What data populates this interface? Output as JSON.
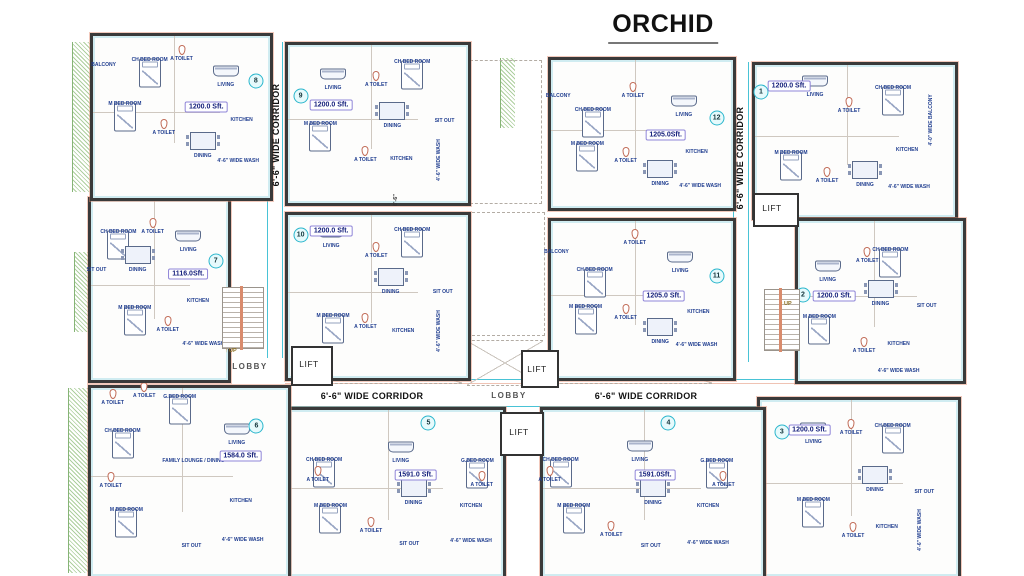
{
  "title": "ORCHID",
  "colors": {
    "wall": "#3a3a3a",
    "accent_cyan": "#49c3d6",
    "accent_orange": "#d98b6c",
    "hatch_green": "#6aa84e",
    "room_label_blue": "#1f3d8f",
    "badge_border": "#9086d8"
  },
  "units": [
    {
      "number": "1",
      "area": "1200.0 Sft.",
      "box": [
        752,
        62,
        200,
        152
      ],
      "circle": [
        3,
        18
      ],
      "badge": [
        17,
        14
      ],
      "rooms": [
        {
          "n": "LIVING",
          "x": 30,
          "y": 20
        },
        {
          "n": "CH BED ROOM",
          "x": 69,
          "y": 15
        },
        {
          "n": "A TOILET",
          "x": 47,
          "y": 30
        },
        {
          "n": "4'-0\" WIDE BALCONY",
          "x": 88,
          "y": 36,
          "v": true
        },
        {
          "n": "M BED ROOM",
          "x": 18,
          "y": 58
        },
        {
          "n": "A TOILET",
          "x": 36,
          "y": 76
        },
        {
          "n": "DINING",
          "x": 55,
          "y": 79
        },
        {
          "n": "KITCHEN",
          "x": 76,
          "y": 56
        },
        {
          "n": "4'-6\" WIDE WASH",
          "x": 77,
          "y": 80
        }
      ]
    },
    {
      "number": "2",
      "area": "1200.0 Sft.",
      "box": [
        795,
        218,
        165,
        160
      ],
      "circle": [
        3,
        46
      ],
      "badge": [
        22,
        47
      ],
      "rooms": [
        {
          "n": "LIVING",
          "x": 18,
          "y": 37
        },
        {
          "n": "CH BED ROOM",
          "x": 56,
          "y": 18
        },
        {
          "n": "A TOILET",
          "x": 42,
          "y": 25
        },
        {
          "n": "M BED ROOM",
          "x": 13,
          "y": 60
        },
        {
          "n": "DINING",
          "x": 50,
          "y": 52
        },
        {
          "n": "SIT OUT",
          "x": 78,
          "y": 53
        },
        {
          "n": "A TOILET",
          "x": 40,
          "y": 81
        },
        {
          "n": "KITCHEN",
          "x": 61,
          "y": 77
        },
        {
          "n": "4'-6\" WIDE WASH",
          "x": 61,
          "y": 94
        }
      ]
    },
    {
      "number": "3",
      "area": "1200.0 Sft.",
      "box": [
        757,
        397,
        198,
        176
      ],
      "circle": [
        11,
        18
      ],
      "badge": [
        25,
        17
      ],
      "rooms": [
        {
          "n": "LIVING",
          "x": 27,
          "y": 24
        },
        {
          "n": "A TOILET",
          "x": 46,
          "y": 19
        },
        {
          "n": "CH BED ROOM",
          "x": 67,
          "y": 15
        },
        {
          "n": "M BED ROOM",
          "x": 27,
          "y": 57
        },
        {
          "n": "DINING",
          "x": 58,
          "y": 51
        },
        {
          "n": "SIT OUT",
          "x": 83,
          "y": 52
        },
        {
          "n": "A TOILET",
          "x": 47,
          "y": 77
        },
        {
          "n": "KITCHEN",
          "x": 64,
          "y": 72
        },
        {
          "n": "4'-6\" WIDE WASH",
          "x": 81,
          "y": 74,
          "v": true
        }
      ]
    },
    {
      "number": "4",
      "area": "1591.0Sft.",
      "box": [
        540,
        407,
        220,
        166
      ],
      "circle": [
        57,
        8
      ],
      "badge": [
        51,
        39
      ],
      "rooms": [
        {
          "n": "CH BED ROOM",
          "x": 8,
          "y": 30
        },
        {
          "n": "LIVING",
          "x": 44,
          "y": 30
        },
        {
          "n": "G.BED ROOM",
          "x": 79,
          "y": 31
        },
        {
          "n": "A TOILET",
          "x": 3,
          "y": 42
        },
        {
          "n": "A TOILET",
          "x": 82,
          "y": 45
        },
        {
          "n": "M BED ROOM",
          "x": 14,
          "y": 58
        },
        {
          "n": "DINING",
          "x": 50,
          "y": 56
        },
        {
          "n": "KITCHEN",
          "x": 75,
          "y": 58
        },
        {
          "n": "A TOILET",
          "x": 31,
          "y": 75
        },
        {
          "n": "SIT OUT",
          "x": 49,
          "y": 82
        },
        {
          "n": "4'-6\" WIDE WASH",
          "x": 75,
          "y": 80
        }
      ]
    },
    {
      "number": "5",
      "area": "1591.0 Sft.",
      "box": [
        287,
        407,
        213,
        166
      ],
      "circle": [
        65,
        8
      ],
      "badge": [
        59,
        39
      ],
      "rooms": [
        {
          "n": "CH BED ROOM",
          "x": 16,
          "y": 30
        },
        {
          "n": "LIVING",
          "x": 52,
          "y": 31
        },
        {
          "n": "G.BED ROOM",
          "x": 88,
          "y": 31
        },
        {
          "n": "A TOILET",
          "x": 13,
          "y": 42
        },
        {
          "n": "A TOILET",
          "x": 90,
          "y": 45
        },
        {
          "n": "M BED ROOM",
          "x": 19,
          "y": 58
        },
        {
          "n": "DINING",
          "x": 58,
          "y": 56
        },
        {
          "n": "KITCHEN",
          "x": 85,
          "y": 58
        },
        {
          "n": "A TOILET",
          "x": 38,
          "y": 73
        },
        {
          "n": "SIT OUT",
          "x": 56,
          "y": 81
        },
        {
          "n": "4'-6\" WIDE WASH",
          "x": 85,
          "y": 79
        }
      ]
    },
    {
      "number": "6",
      "area": "1584.0 Sft.",
      "box": [
        88,
        385,
        197,
        188
      ],
      "circle": [
        84,
        20
      ],
      "badge": [
        76,
        36
      ],
      "rooms": [
        {
          "n": "A TOILET",
          "x": 11,
          "y": 8
        },
        {
          "n": "A TOILET",
          "x": 27,
          "y": 4
        },
        {
          "n": "G.BED ROOM",
          "x": 45,
          "y": 5
        },
        {
          "n": "CH BED ROOM",
          "x": 16,
          "y": 23
        },
        {
          "n": "LIVING",
          "x": 74,
          "y": 29
        },
        {
          "n": "FAMILY LOUNGE / DINING",
          "x": 52,
          "y": 39
        },
        {
          "n": "A TOILET",
          "x": 10,
          "y": 52
        },
        {
          "n": "M BED ROOM",
          "x": 18,
          "y": 65
        },
        {
          "n": "KITCHEN",
          "x": 76,
          "y": 60
        },
        {
          "n": "SIT OUT",
          "x": 51,
          "y": 84
        },
        {
          "n": "4'-6\" WIDE WASH",
          "x": 77,
          "y": 81
        }
      ]
    },
    {
      "number": "7",
      "area": "1116.0Sft.",
      "box": [
        88,
        197,
        137,
        180
      ],
      "circle": [
        91,
        34
      ],
      "badge": [
        71,
        41
      ],
      "rooms": [
        {
          "n": "CH BED ROOM",
          "x": 20,
          "y": 18
        },
        {
          "n": "A TOILET",
          "x": 45,
          "y": 18
        },
        {
          "n": "LIVING",
          "x": 71,
          "y": 28
        },
        {
          "n": "SIT OUT",
          "x": 4,
          "y": 39
        },
        {
          "n": "DINING",
          "x": 34,
          "y": 39
        },
        {
          "n": "M BED ROOM",
          "x": 32,
          "y": 60
        },
        {
          "n": "A TOILET",
          "x": 56,
          "y": 72
        },
        {
          "n": "KITCHEN",
          "x": 78,
          "y": 56
        },
        {
          "n": "4'-6\" WIDE WASH",
          "x": 82,
          "y": 80
        }
      ]
    },
    {
      "number": "8",
      "area": "1200.0 Sft.",
      "box": [
        90,
        33,
        177,
        162
      ],
      "circle": [
        92,
        28
      ],
      "badge": [
        64,
        44
      ],
      "rooms": [
        {
          "n": "BALCONY",
          "x": 6,
          "y": 18
        },
        {
          "n": "CH BED ROOM",
          "x": 32,
          "y": 15
        },
        {
          "n": "A TOILET",
          "x": 50,
          "y": 14
        },
        {
          "n": "LIVING",
          "x": 75,
          "y": 30
        },
        {
          "n": "M BED ROOM",
          "x": 18,
          "y": 42
        },
        {
          "n": "A TOILET",
          "x": 40,
          "y": 60
        },
        {
          "n": "DINING",
          "x": 62,
          "y": 74
        },
        {
          "n": "KITCHEN",
          "x": 84,
          "y": 52
        },
        {
          "n": "4'-6\" WIDE WASH",
          "x": 82,
          "y": 77
        }
      ]
    },
    {
      "number": "9",
      "area": "1200.0 Sft.",
      "box": [
        285,
        42,
        180,
        158
      ],
      "circle": [
        7,
        32
      ],
      "badge": [
        24,
        38
      ],
      "rooms": [
        {
          "n": "LIVING",
          "x": 25,
          "y": 27
        },
        {
          "n": "A TOILET",
          "x": 49,
          "y": 25
        },
        {
          "n": "CH BED ROOM",
          "x": 69,
          "y": 11
        },
        {
          "n": "M BED ROOM",
          "x": 18,
          "y": 50
        },
        {
          "n": "DINING",
          "x": 58,
          "y": 51
        },
        {
          "n": "SIT OUT",
          "x": 87,
          "y": 48
        },
        {
          "n": "A TOILET",
          "x": 43,
          "y": 73
        },
        {
          "n": "KITCHEN",
          "x": 63,
          "y": 72
        },
        {
          "n": "4'-6\" WIDE WASH",
          "x": 84,
          "y": 73,
          "v": true
        }
      ]
    },
    {
      "number": "10",
      "area": "1200.0 Sft.",
      "box": [
        285,
        212,
        180,
        163
      ],
      "circle": [
        7,
        12
      ],
      "badge": [
        24,
        10
      ],
      "rooms": [
        {
          "n": "LIVING",
          "x": 24,
          "y": 19
        },
        {
          "n": "A TOILET",
          "x": 49,
          "y": 25
        },
        {
          "n": "CH BED ROOM",
          "x": 69,
          "y": 9
        },
        {
          "n": "M BED ROOM",
          "x": 25,
          "y": 62
        },
        {
          "n": "DINING",
          "x": 57,
          "y": 47
        },
        {
          "n": "SIT OUT",
          "x": 86,
          "y": 47
        },
        {
          "n": "A TOILET",
          "x": 43,
          "y": 69
        },
        {
          "n": "KITCHEN",
          "x": 64,
          "y": 71
        },
        {
          "n": "4'-6\" WIDE WASH",
          "x": 84,
          "y": 71,
          "v": true
        }
      ]
    },
    {
      "number": "11",
      "area": "1205.0 Sft.",
      "box": [
        548,
        218,
        182,
        157
      ],
      "circle": [
        91,
        35
      ],
      "badge": [
        62,
        48
      ],
      "rooms": [
        {
          "n": "BALCONY",
          "x": 3,
          "y": 20
        },
        {
          "n": "CH BED ROOM",
          "x": 24,
          "y": 31
        },
        {
          "n": "A TOILET",
          "x": 46,
          "y": 14
        },
        {
          "n": "LIVING",
          "x": 71,
          "y": 32
        },
        {
          "n": "M BED ROOM",
          "x": 19,
          "y": 55
        },
        {
          "n": "A TOILET",
          "x": 41,
          "y": 62
        },
        {
          "n": "DINING",
          "x": 60,
          "y": 77
        },
        {
          "n": "KITCHEN",
          "x": 81,
          "y": 58
        },
        {
          "n": "4'-6\" WIDE WASH",
          "x": 80,
          "y": 79
        }
      ]
    },
    {
      "number": "12",
      "area": "1205.0Sft.",
      "box": [
        548,
        57,
        182,
        148
      ],
      "circle": [
        91,
        39
      ],
      "badge": [
        63,
        51
      ],
      "rooms": [
        {
          "n": "BALCONY",
          "x": 4,
          "y": 24
        },
        {
          "n": "CH BED ROOM",
          "x": 23,
          "y": 34
        },
        {
          "n": "A TOILET",
          "x": 45,
          "y": 24
        },
        {
          "n": "LIVING",
          "x": 73,
          "y": 37
        },
        {
          "n": "M BED ROOM",
          "x": 20,
          "y": 57
        },
        {
          "n": "A TOILET",
          "x": 41,
          "y": 68
        },
        {
          "n": "DINING",
          "x": 60,
          "y": 84
        },
        {
          "n": "KITCHEN",
          "x": 80,
          "y": 62
        },
        {
          "n": "4'-6\" WIDE WASH",
          "x": 82,
          "y": 85
        }
      ]
    }
  ],
  "annotations": [
    {
      "t": "6'-6\" WIDE CORRIDOR",
      "x": 276,
      "y": 135,
      "dir": "v",
      "cls": "bold"
    },
    {
      "t": "6'-6\" WIDE CORRIDOR",
      "x": 740,
      "y": 158,
      "dir": "v",
      "cls": "bold"
    },
    {
      "t": "6'-6\" WIDE CORRIDOR",
      "x": 372,
      "y": 396,
      "cls": "bold"
    },
    {
      "t": "6'-6\" WIDE CORRIDOR",
      "x": 646,
      "y": 396,
      "cls": "bold"
    },
    {
      "t": "LOBBY",
      "x": 250,
      "y": 367,
      "cls": "room"
    },
    {
      "t": "LOBBY",
      "x": 509,
      "y": 396,
      "cls": "room"
    },
    {
      "t": "LIFT",
      "x": 309,
      "y": 364,
      "cls": "lift"
    },
    {
      "t": "LIFT",
      "x": 537,
      "y": 369,
      "cls": "lift"
    },
    {
      "t": "LIFT",
      "x": 772,
      "y": 208,
      "cls": "lift"
    },
    {
      "t": "LIFT",
      "x": 519,
      "y": 432,
      "cls": "lift"
    },
    {
      "t": "UP",
      "x": 231,
      "y": 351,
      "cls": "up"
    },
    {
      "t": "UP",
      "x": 786,
      "y": 304,
      "cls": "up"
    },
    {
      "t": "6'-6\"",
      "x": 396,
      "y": 200,
      "dir": "v",
      "cls": "dim"
    }
  ]
}
